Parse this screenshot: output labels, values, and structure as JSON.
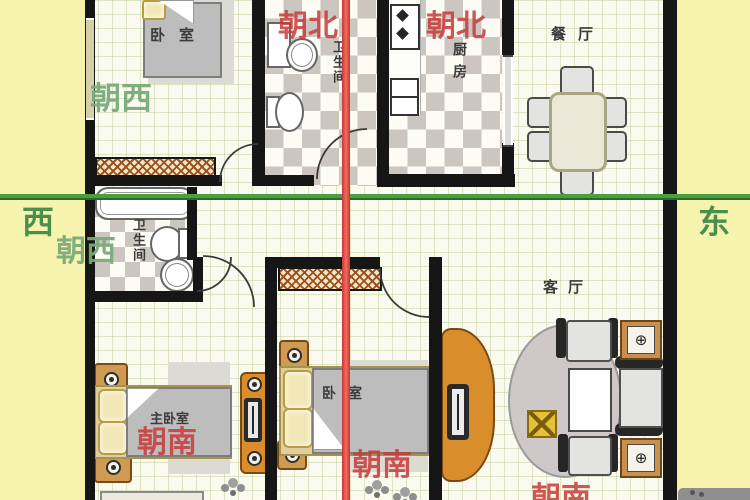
{
  "plan": {
    "compass": {
      "west": "西",
      "east": "东"
    },
    "orientation": {
      "facing_north_left": "朝北",
      "facing_north_right": "朝北",
      "facing_west_top": "朝西",
      "facing_west_mid": "朝西",
      "facing_south_master": "朝南",
      "facing_south_bedroom": "朝南",
      "facing_south_living": "朝南"
    },
    "rooms": {
      "bedroom_top": "卧室",
      "bathroom_top": "卫生间",
      "kitchen": "厨房",
      "dining": "餐厅",
      "bathroom_mid": "卫生间",
      "living": "客厅",
      "master_bedroom": "主卧室",
      "bedroom_bottom": "卧室"
    },
    "plant_table_symbol": "⊕",
    "colors": {
      "axis_east_west": "#4aa03f",
      "axis_north_south": "#e04343",
      "facing_red_label": "#c63a3a",
      "facing_green_label": "#7aaa7a",
      "compass_green_label": "#4c8f4c",
      "outside_band": "#f5f3ad",
      "wall": "#161616",
      "checker_grey": "#ccc6c1",
      "furniture_wood": "#d98d2b"
    }
  }
}
